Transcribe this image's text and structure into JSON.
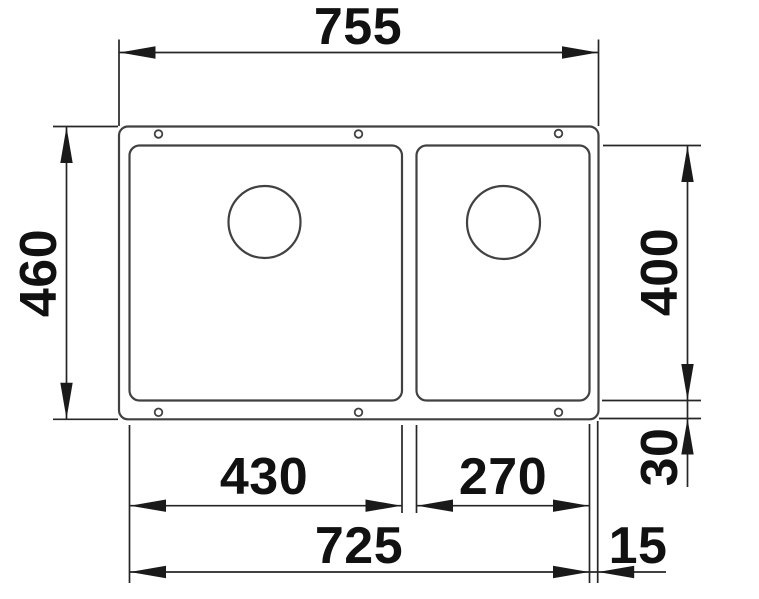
{
  "drawing": {
    "kind": "double-bowl undermount sink, top view technical drawing",
    "units": "mm",
    "background_color": "#ffffff",
    "outline_color": "#414141",
    "dimension_line_color": "#262626",
    "text_color": "#111111"
  },
  "dims": {
    "overall_width": "755",
    "overall_depth": "460",
    "bowl_inner_depth": "400",
    "bottom_rim_offset": "30",
    "left_bowl_width": "430",
    "right_bowl_width": "270",
    "inner_span_width": "725",
    "right_edge_gap": "15"
  }
}
